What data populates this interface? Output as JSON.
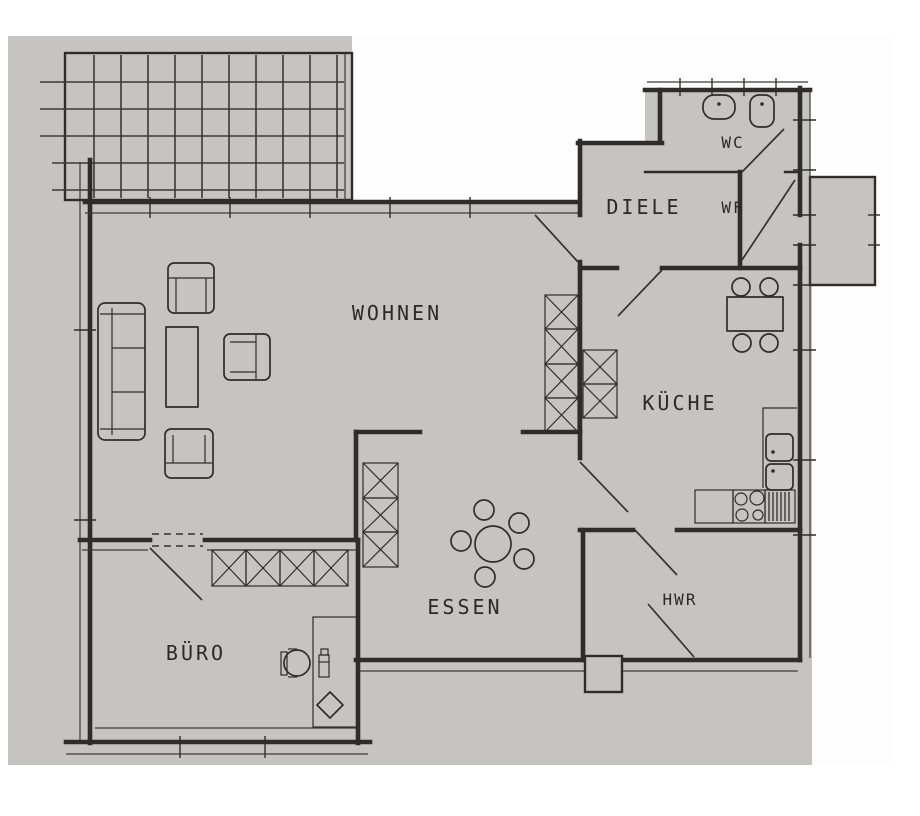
{
  "plan": {
    "kind_note": "scanned apartment floor plan",
    "rooms": {
      "wohnen": {
        "label": "WOHNEN"
      },
      "diele": {
        "label": "DIELE"
      },
      "wc": {
        "label": "WC"
      },
      "wf": {
        "label": "WF"
      },
      "kueche": {
        "label": "KÜCHE"
      },
      "essen": {
        "label": "ESSEN"
      },
      "hwr": {
        "label": "HWR"
      },
      "buero": {
        "label": "BÜRO"
      }
    },
    "colors": {
      "paper": "#c6c4c1",
      "ink": "#2e2d2a",
      "background": "#ffffff"
    }
  }
}
